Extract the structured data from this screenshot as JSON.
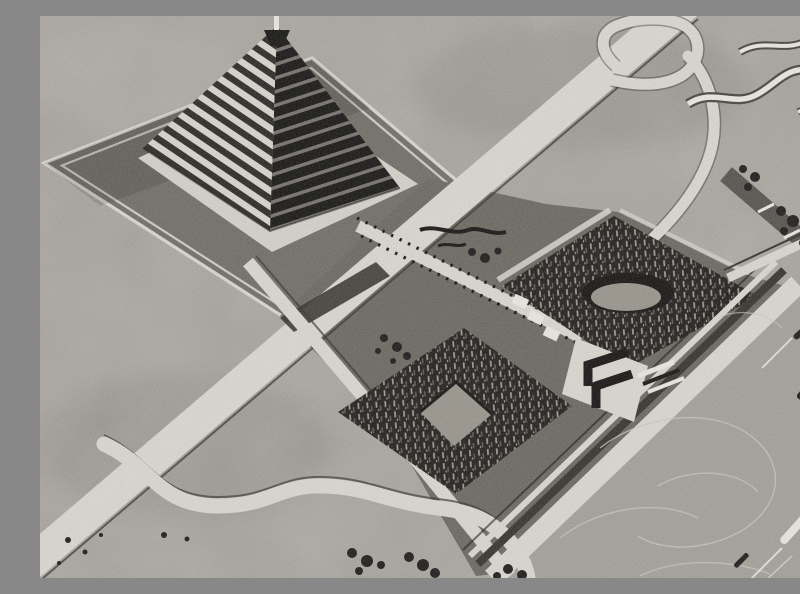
{
  "meta": {
    "title": "Aerial perspective drawing of a stepped-pyramid memorial complex",
    "description": "Black-and-white halftone photograph of an architectural bird's-eye perspective: a terraced stepped pyramid with a spire stands on a dark diamond plaza; a straight diagonal highway with a looping interchange ramp crosses the grounds; a statue-lined causeway leads between two dense planted groves (one holding an oval amphitheatre hollow, the other a square clearing) to a zigzag stepped monument on a layered quay; a river with boats and swirling wakes runs along the lower right, with winding creeks and tree clusters on the far ground.",
    "media_type": "halftone print, no visible text or captions"
  },
  "palette": {
    "ground": "#a8a49d",
    "plaza": "#716d66",
    "park": "#6b6760",
    "river": "#a39f98",
    "road": "#d9d6cf",
    "white": "#e9e6df",
    "shadow": "#35332e",
    "ink": "#161513",
    "blob": "#1d1c1a",
    "apron": "#d3d0c9",
    "stepL": "#d7d3cc",
    "stepLd": "#2a2926",
    "stepR": "#84817a",
    "stepRd": "#1b1a18",
    "forest": "#21201d",
    "tree1": "#a19d96",
    "tree2": "#605d57",
    "clearing": "#98948c",
    "wake": "#cac7c0",
    "band": "#474440"
  },
  "scene": {
    "landmarks": [
      "stepped pyramid with spire",
      "diamond plaza with white border paths",
      "main diagonal highway",
      "loop interchange ramp",
      "statue-lined causeway",
      "upper grove with oval amphitheatre",
      "lower grove with square clearing",
      "zigzag riverfront monument",
      "layered quay and embankment",
      "river with boats and wakes",
      "bridge road",
      "tree-lined far-bank road",
      "winding creeks",
      "scattered shrubs and bushes"
    ]
  }
}
